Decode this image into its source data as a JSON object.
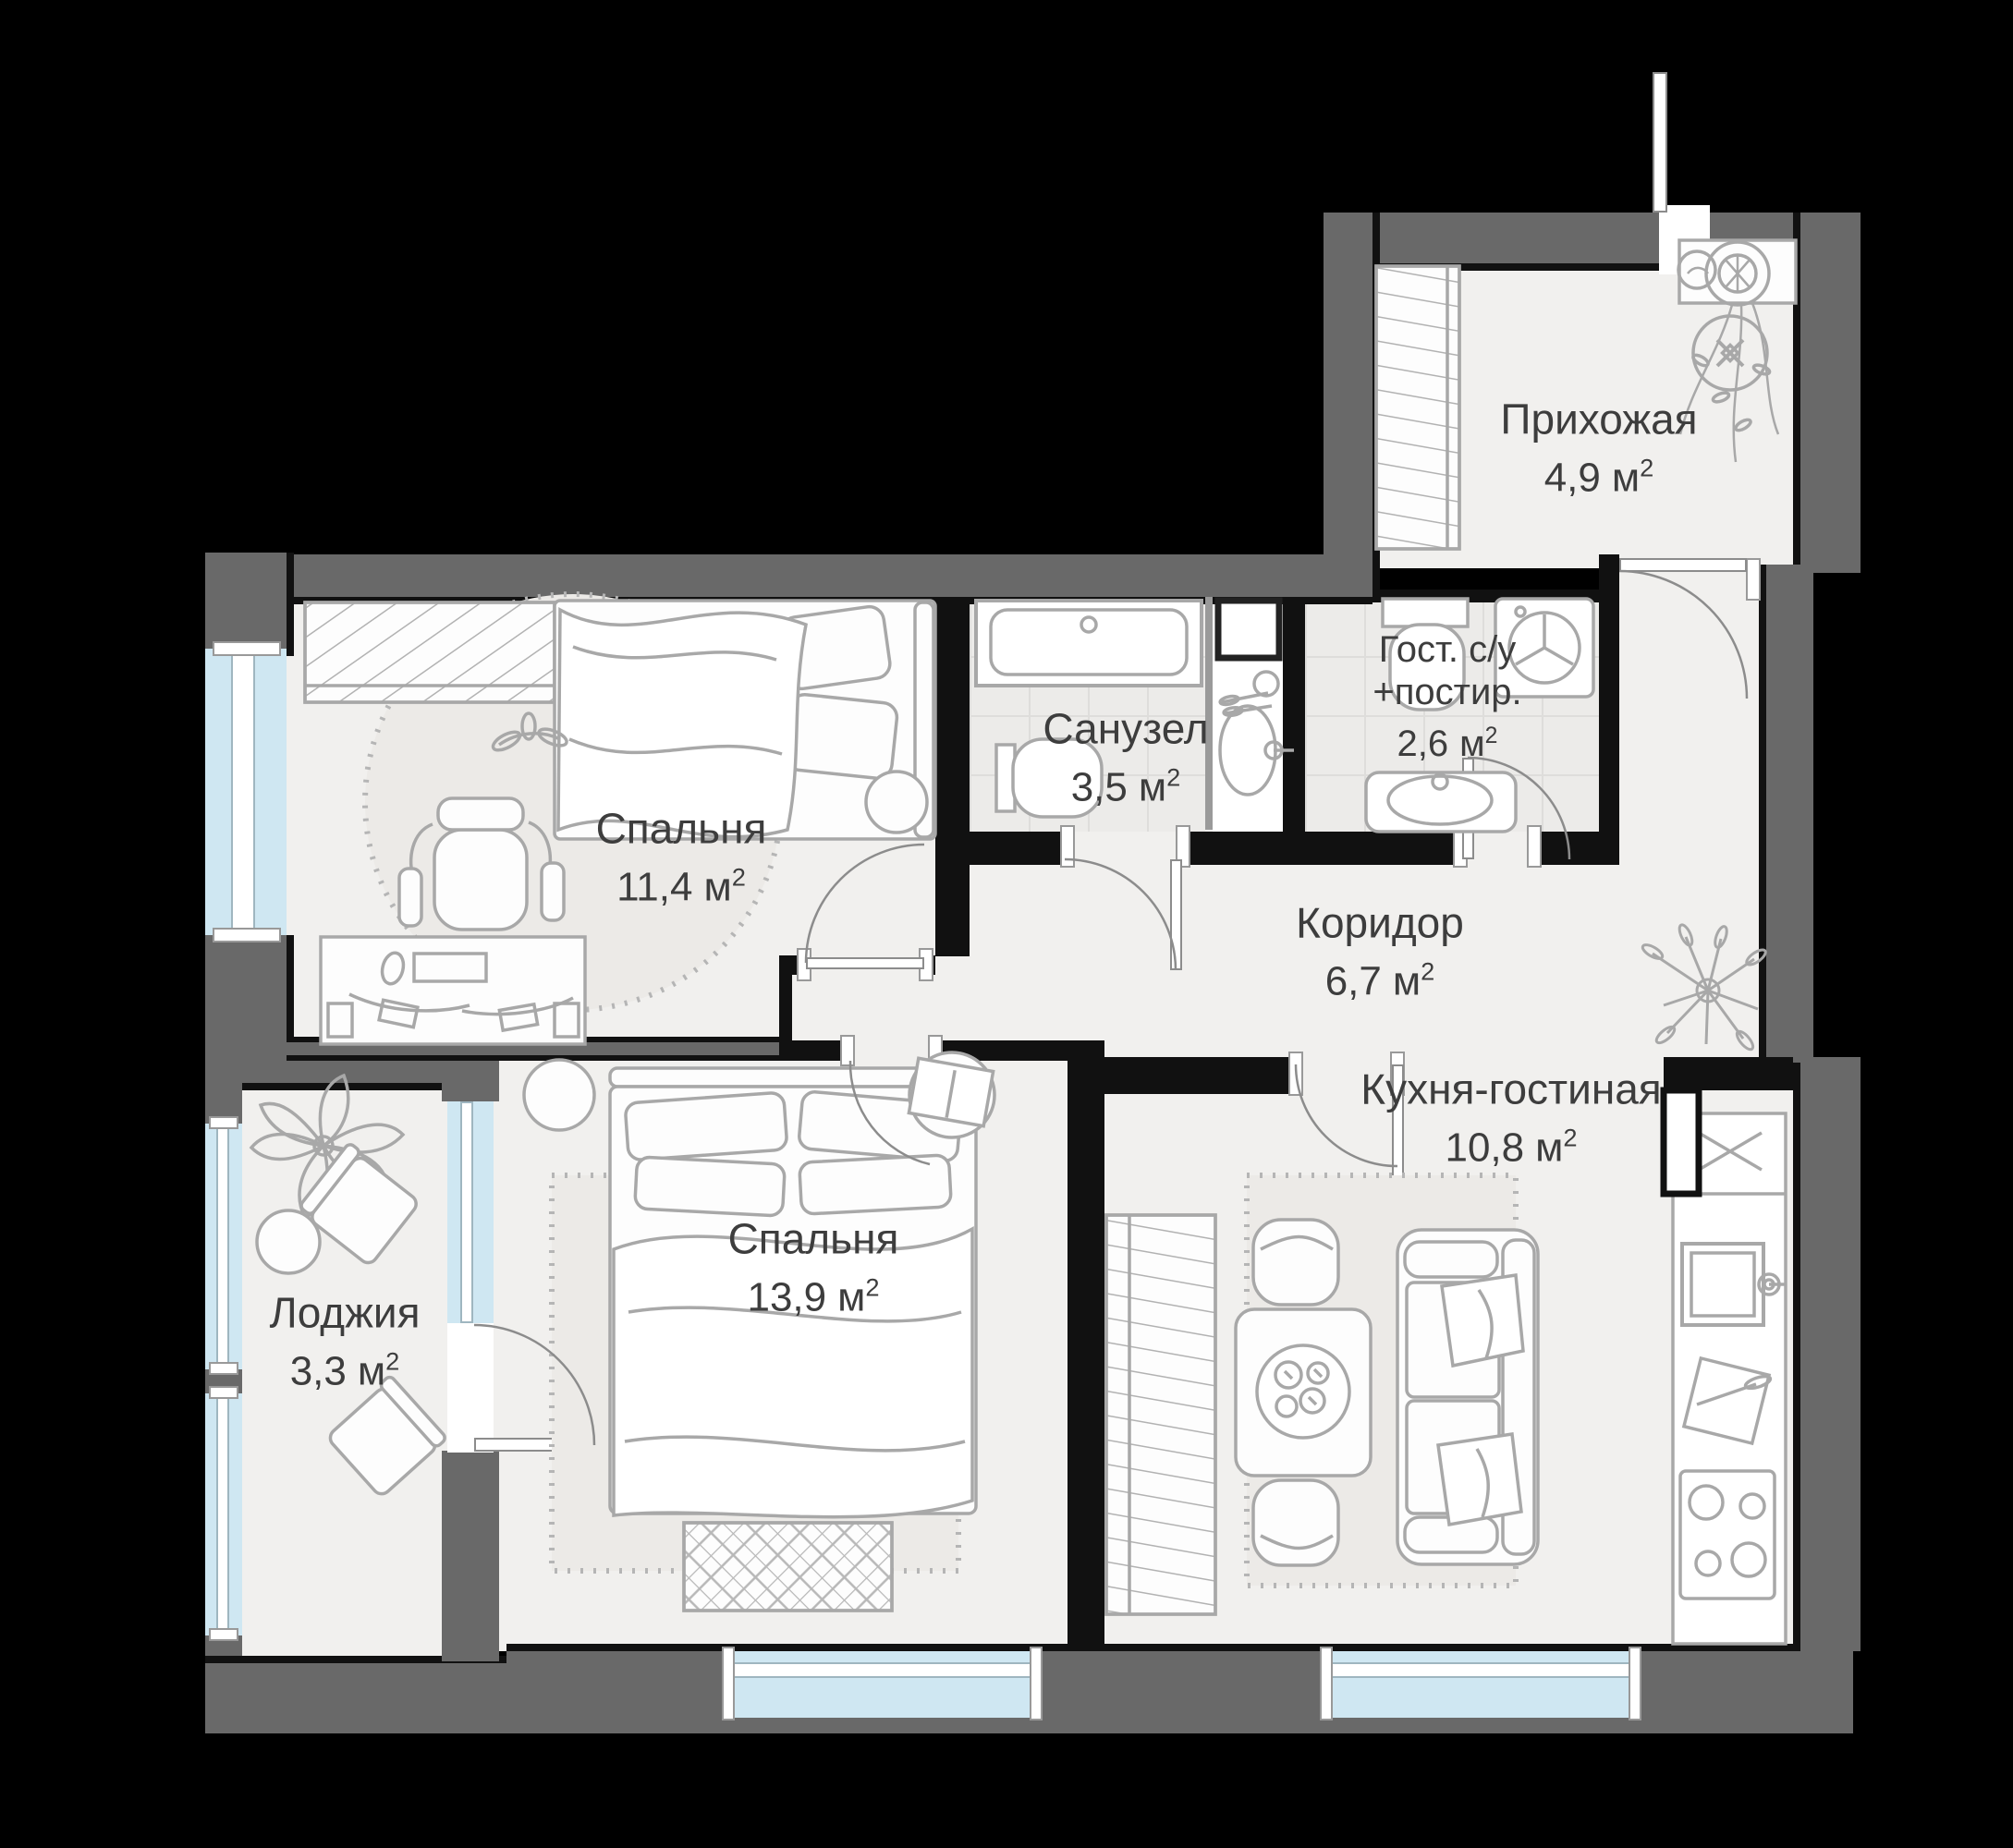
{
  "plan": {
    "type": "apartment-floor-plan",
    "language": "ru",
    "units": {
      "metre": "м",
      "power": "2"
    },
    "rooms": [
      {
        "id": "hallway",
        "name": "Прихожая",
        "area": "4,9"
      },
      {
        "id": "bedroom-1",
        "name": "Спальня",
        "area": "11,4"
      },
      {
        "id": "bathroom",
        "name": "Санузел",
        "area": "3,5"
      },
      {
        "id": "guest-wc",
        "name": "Гост. с/у",
        "name_line2": "+постир.",
        "area": "2,6"
      },
      {
        "id": "corridor",
        "name": "Коридор",
        "area": "6,7"
      },
      {
        "id": "bedroom-2",
        "name": "Спальня",
        "area": "13,9"
      },
      {
        "id": "kitchen-living",
        "name": "Кухня-гостиная",
        "area": "10,8"
      },
      {
        "id": "loggia",
        "name": "Лоджия",
        "area": "3,3"
      }
    ],
    "colors": {
      "background": "#000000",
      "exterior_wall": "#696969",
      "wall_line": "#111111",
      "floor": "#f1f0ee",
      "tile_floor": "#ecebe9",
      "window_glass": "#cfe7f2",
      "furniture_stroke": "#a8a8a8",
      "label_text": "#3d3d3d"
    }
  }
}
